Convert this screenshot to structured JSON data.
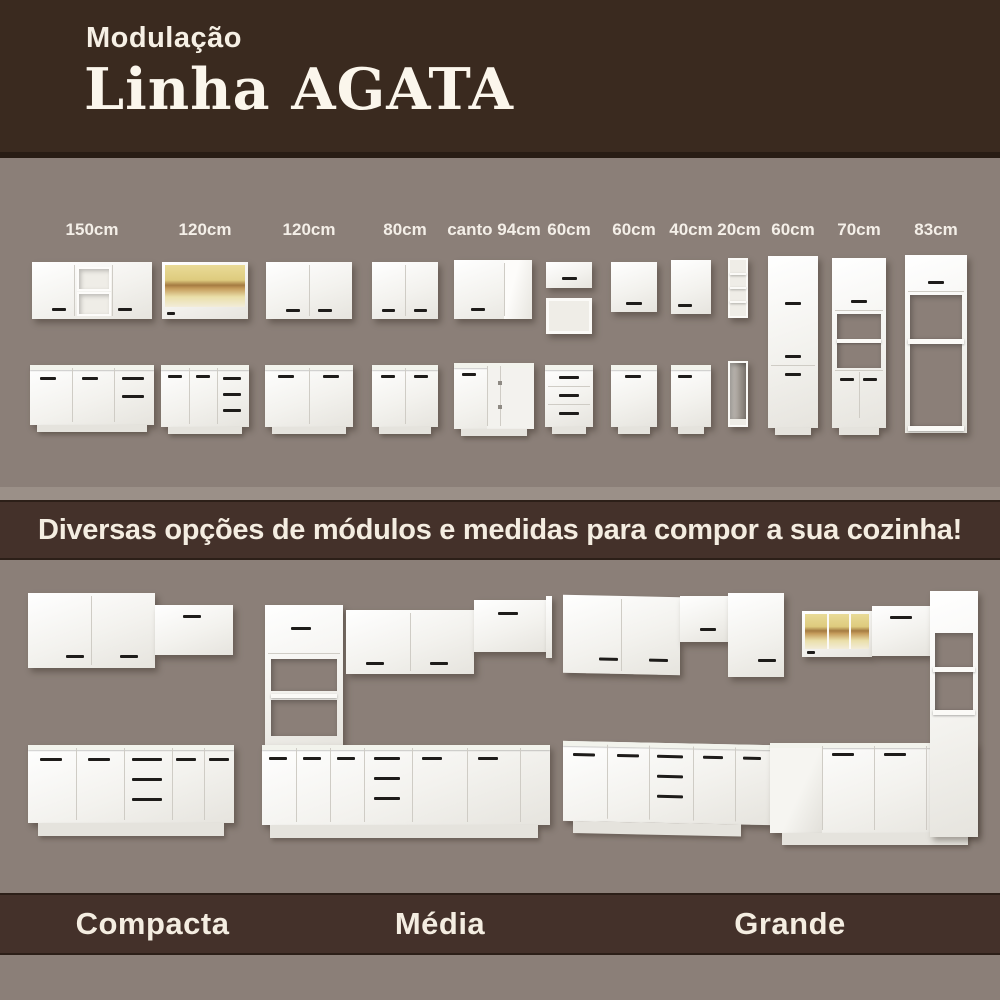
{
  "header": {
    "subtitle": "Modulação",
    "title": "Linha AGATA"
  },
  "modules_section": {
    "items": [
      {
        "size": "150cm",
        "type": "wall-2-doors-center-niches-and-base-doors-drawers"
      },
      {
        "size": "120cm",
        "type": "wall-glass-wood-cabinet-and-base-2-doors-3-drawers"
      },
      {
        "size": "120cm",
        "type": "wall-2-doors-and-base-2-doors"
      },
      {
        "size": "80cm",
        "type": "wall-2-doors-and-base-2-doors"
      },
      {
        "size": "canto 94cm",
        "type": "corner-wall-and-corner-base"
      },
      {
        "size": "60cm",
        "type": "small-wall-door-open-box-and-base-3-drawers"
      },
      {
        "size": "60cm",
        "type": "wall-1-door-and-base-1-door"
      },
      {
        "size": "40cm",
        "type": "wall-1-door-and-base-1-door"
      },
      {
        "size": "20cm",
        "type": "open-shelf-column-and-open-base-column"
      },
      {
        "size": "60cm",
        "type": "tall-pantry-2-doors"
      },
      {
        "size": "70cm",
        "type": "tall-tower-open-middle-2-lower-doors"
      },
      {
        "size": "83cm",
        "type": "tall-surround-top-door-open-frame"
      }
    ]
  },
  "banner": {
    "text": "Diversas opções de módulos e medidas para compor a sua cozinha!"
  },
  "kitchens": {
    "items": [
      {
        "label": "Compacta"
      },
      {
        "label": "Média"
      },
      {
        "label": "Grande"
      }
    ]
  },
  "colors": {
    "header_brown": "#3a2a1f",
    "band_brown": "#44312a",
    "background_gray": "#8b7f78",
    "cabinet_white": "#f7f6f2",
    "wood_tone": "#dcc87e",
    "handle_black": "#1e1c1a",
    "text_cream": "#f5efe4"
  }
}
